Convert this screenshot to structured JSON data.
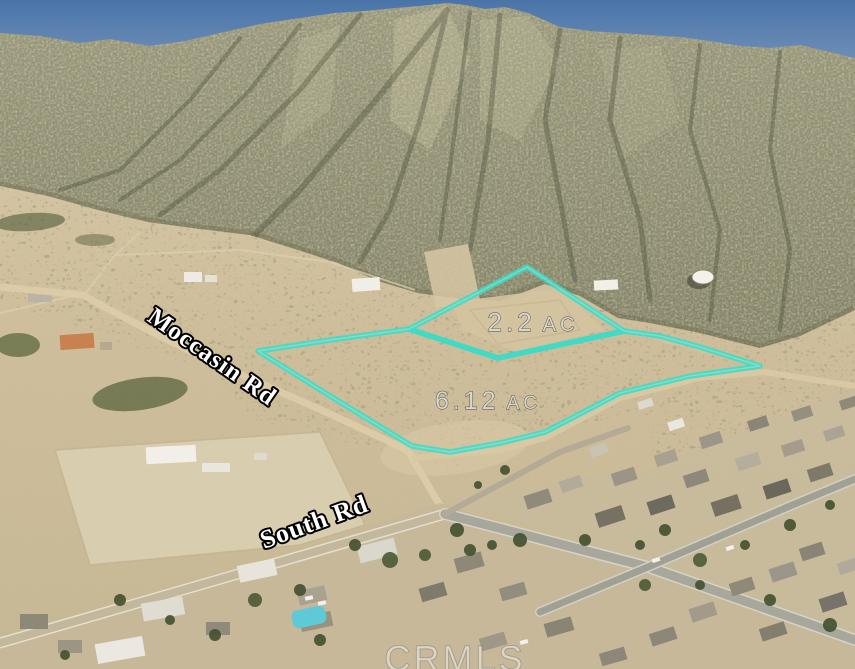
{
  "scene": {
    "description": "Oblique aerial satellite photo of two desert land parcels at the base of a mountain, with a residential neighborhood to the south",
    "watermark": "CRMLS"
  },
  "roads": [
    {
      "id": "moccasin-rd",
      "label": "Moccasin Rd"
    },
    {
      "id": "south-rd",
      "label": "South Rd"
    }
  ],
  "parcels": [
    {
      "id": "north-parcel",
      "acres": "2.2",
      "unit": "AC",
      "label": "2.2 AC"
    },
    {
      "id": "south-parcel",
      "acres": "6.12",
      "unit": "AC",
      "label": "6.12 AC"
    }
  ],
  "colors": {
    "parcel_outline": "#3edac6",
    "parcel_outline_glow": "#9beede",
    "road_label_fill": "#ffffff",
    "road_label_outline": "#000000",
    "acreage_label_fill": "#d8d7cf",
    "acreage_label_outline": "#4b4a40",
    "sky_top": "#4a74a8",
    "sky_bottom": "#82a0c8",
    "desert_tan": "#d2c2a0",
    "mountain_olive": "#8f8d6f",
    "pavement_gray": "#a8a79b",
    "pool_blue": "#5fc9d7"
  }
}
